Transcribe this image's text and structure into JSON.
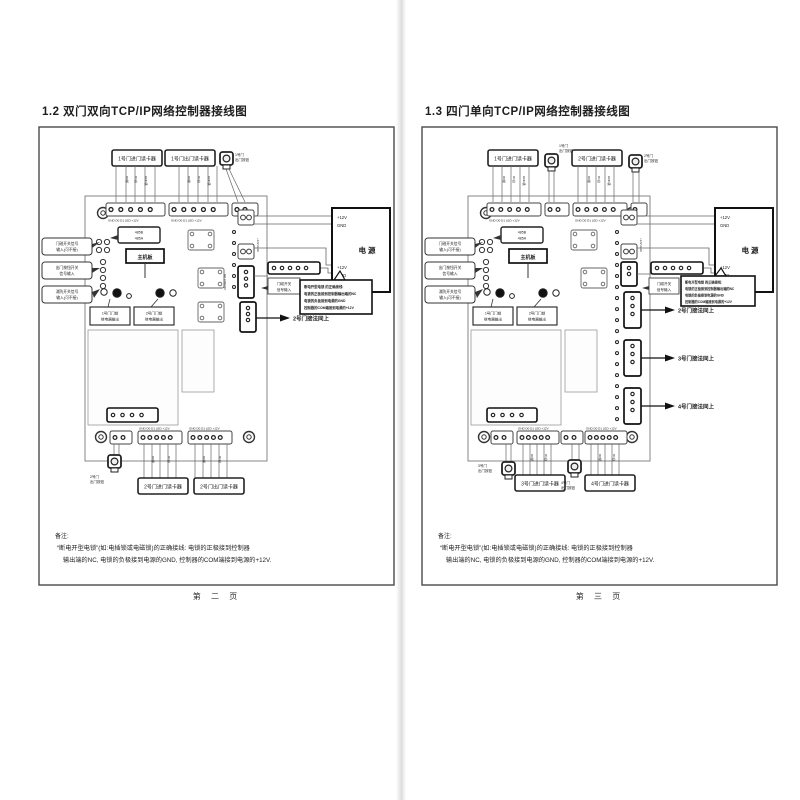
{
  "doc": {
    "wire_labels": [
      "D0绿",
      "D1白",
      "GND黑"
    ],
    "pages": [
      {
        "title": "1.2 双门双向TCP/IP网络控制器接线图",
        "footer": "第 二 页",
        "top_readers": [
          "1号门进门读卡器",
          "1号门出门读卡器"
        ],
        "top_button": [
          "1号门",
          "出门按钮"
        ],
        "bottom_readers": [
          "2号门进门读卡器",
          "2号门出门读卡器"
        ],
        "bottom_button": [
          "2号门",
          "出门按钮"
        ],
        "left_callouts": [
          [
            "门磁开关信号",
            "输入(可不接)"
          ],
          [
            "出门按钮开关",
            "信号输入"
          ],
          [
            "消防开关信号",
            "输入(可不接)"
          ]
        ],
        "pin_header": [
          "485B",
          "485A"
        ],
        "board_label": "主机板",
        "inner_labels": [
          [
            "1号门门锁",
            "继电器输出"
          ],
          [
            "2号门门锁",
            "继电器输出"
          ]
        ],
        "power_box": {
          "v1": "+12V",
          "g1": "GND",
          "name": "电 源",
          "v2": "+12V",
          "g2": "GND"
        },
        "sensor_box": [
          "门磁开关",
          "信号输入"
        ],
        "warning": [
          "断电开型电锁 的正确接线:",
          "电锁的正极接到控制器输出端的NC",
          "电锁的负极接到电源的GND",
          "控制器的COM端接到电源的+12V"
        ],
        "arrows": [
          "2号门接法同上"
        ],
        "pin_row": "GND D0 D1 LED +12V",
        "edge_pins": {
          "power": "+12V GND",
          "lock": "NO COM NC"
        },
        "note": {
          "heading": "备注:",
          "line1": "“断电开型电锁”(如:电插锁或电磁锁)的正确接线: 电锁的正极接到控制器",
          "line2": "输出端的NC, 电锁的负极接到电源的GND, 控制器的COM端接到电源的+12V."
        }
      },
      {
        "title": "1.3 四门单向TCP/IP网络控制器接线图",
        "footer": "第 三 页",
        "top_readers": [
          "1号门进门读卡器",
          "2号门进门读卡器"
        ],
        "top_buttons": [
          [
            "1号门",
            "出门按钮"
          ],
          [
            "2号门",
            "出门按钮"
          ]
        ],
        "bottom_readers": [
          "3号门进门读卡器",
          "4号门进门读卡器"
        ],
        "bottom_buttons": [
          [
            "3号门",
            "出门按钮"
          ],
          [
            "4号门",
            "出门按钮"
          ]
        ],
        "left_callouts": [
          [
            "门磁开关信号",
            "输入(可不接)"
          ],
          [
            "出门按钮开关",
            "信号输入"
          ],
          [
            "消防开关信号",
            "输入(可不接)"
          ]
        ],
        "pin_header": [
          "485B",
          "485A"
        ],
        "board_label": "主机板",
        "inner_labels": [
          [
            "1号门门锁",
            "继电器输出"
          ],
          [
            "2号门门锁",
            "继电器输出"
          ]
        ],
        "power_box": {
          "v1": "+12V",
          "g1": "GND",
          "name": "电 源",
          "v2": "+12V",
          "g2": "GND"
        },
        "sensor_box": [
          "门磁开关",
          "信号输入"
        ],
        "warning": [
          "断电开型电锁 的正确接线:",
          "电锁的正极接到控制器输出端的NC",
          "电锁的负极接到电源的GND",
          "控制器的COM端接到电源的+12V"
        ],
        "arrows": [
          "2号门接法同上",
          "3号门接法同上",
          "4号门接法同上"
        ],
        "pin_row": "GND D0 D1 LED +12V",
        "edge_pins": {
          "power": "+12V GND",
          "lock": "NO COM NC"
        },
        "note": {
          "heading": "备注:",
          "line1": "“断电开型电锁”(如:电插锁或电磁锁)的正确接线: 电锁的正极接到控制器",
          "line2": "输出端的NC, 电锁的负极接到电源的GND, 控制器的COM端接到电源的+12V."
        }
      }
    ]
  }
}
